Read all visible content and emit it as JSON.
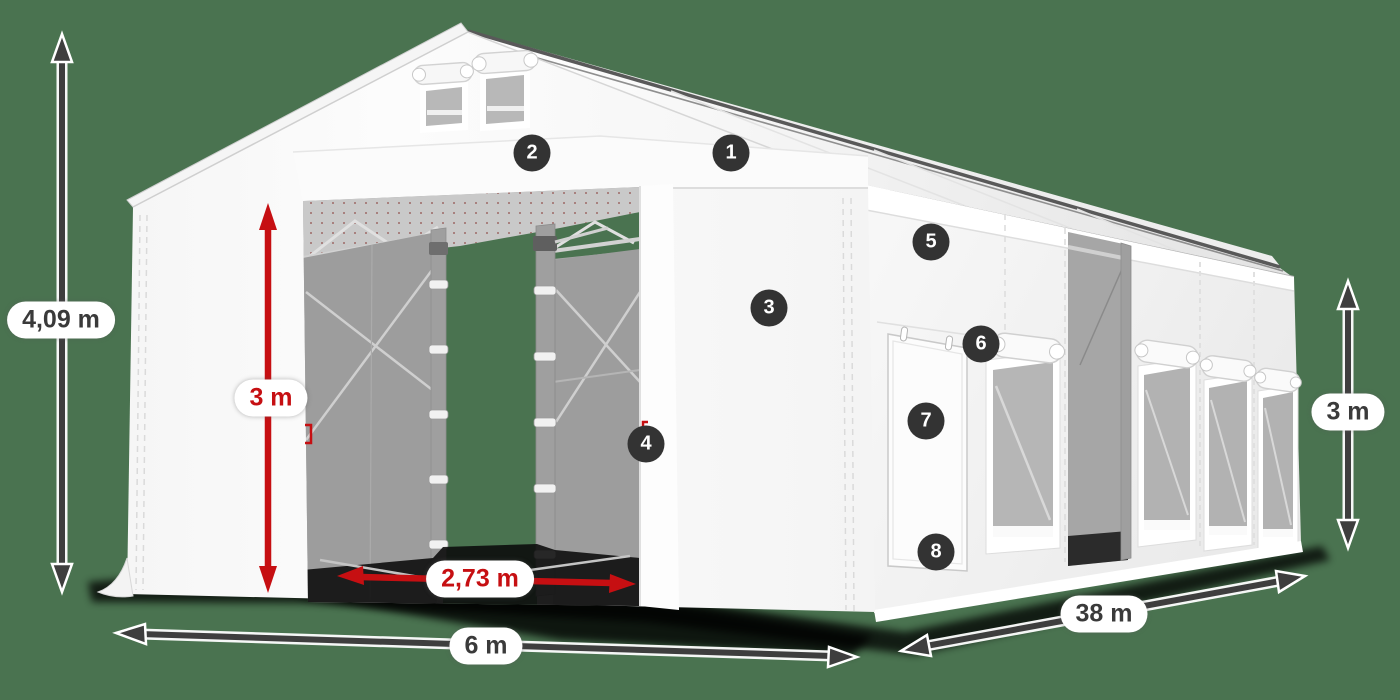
{
  "title": "Storage tent dimension diagram",
  "colors": {
    "bg": "#4a7350",
    "red": "#c60f12",
    "marker": "#333333",
    "arrow": "#3e3e3e",
    "text": "#3a3a3a"
  },
  "markers": [
    "1",
    "2",
    "3",
    "4",
    "5",
    "6",
    "7",
    "8"
  ],
  "dimensions": {
    "total_height": "4,09 m",
    "door_height": "3 m",
    "door_width": "2,73 m",
    "front_width": "6 m",
    "side_length": "38 m",
    "side_height": "3 m"
  }
}
